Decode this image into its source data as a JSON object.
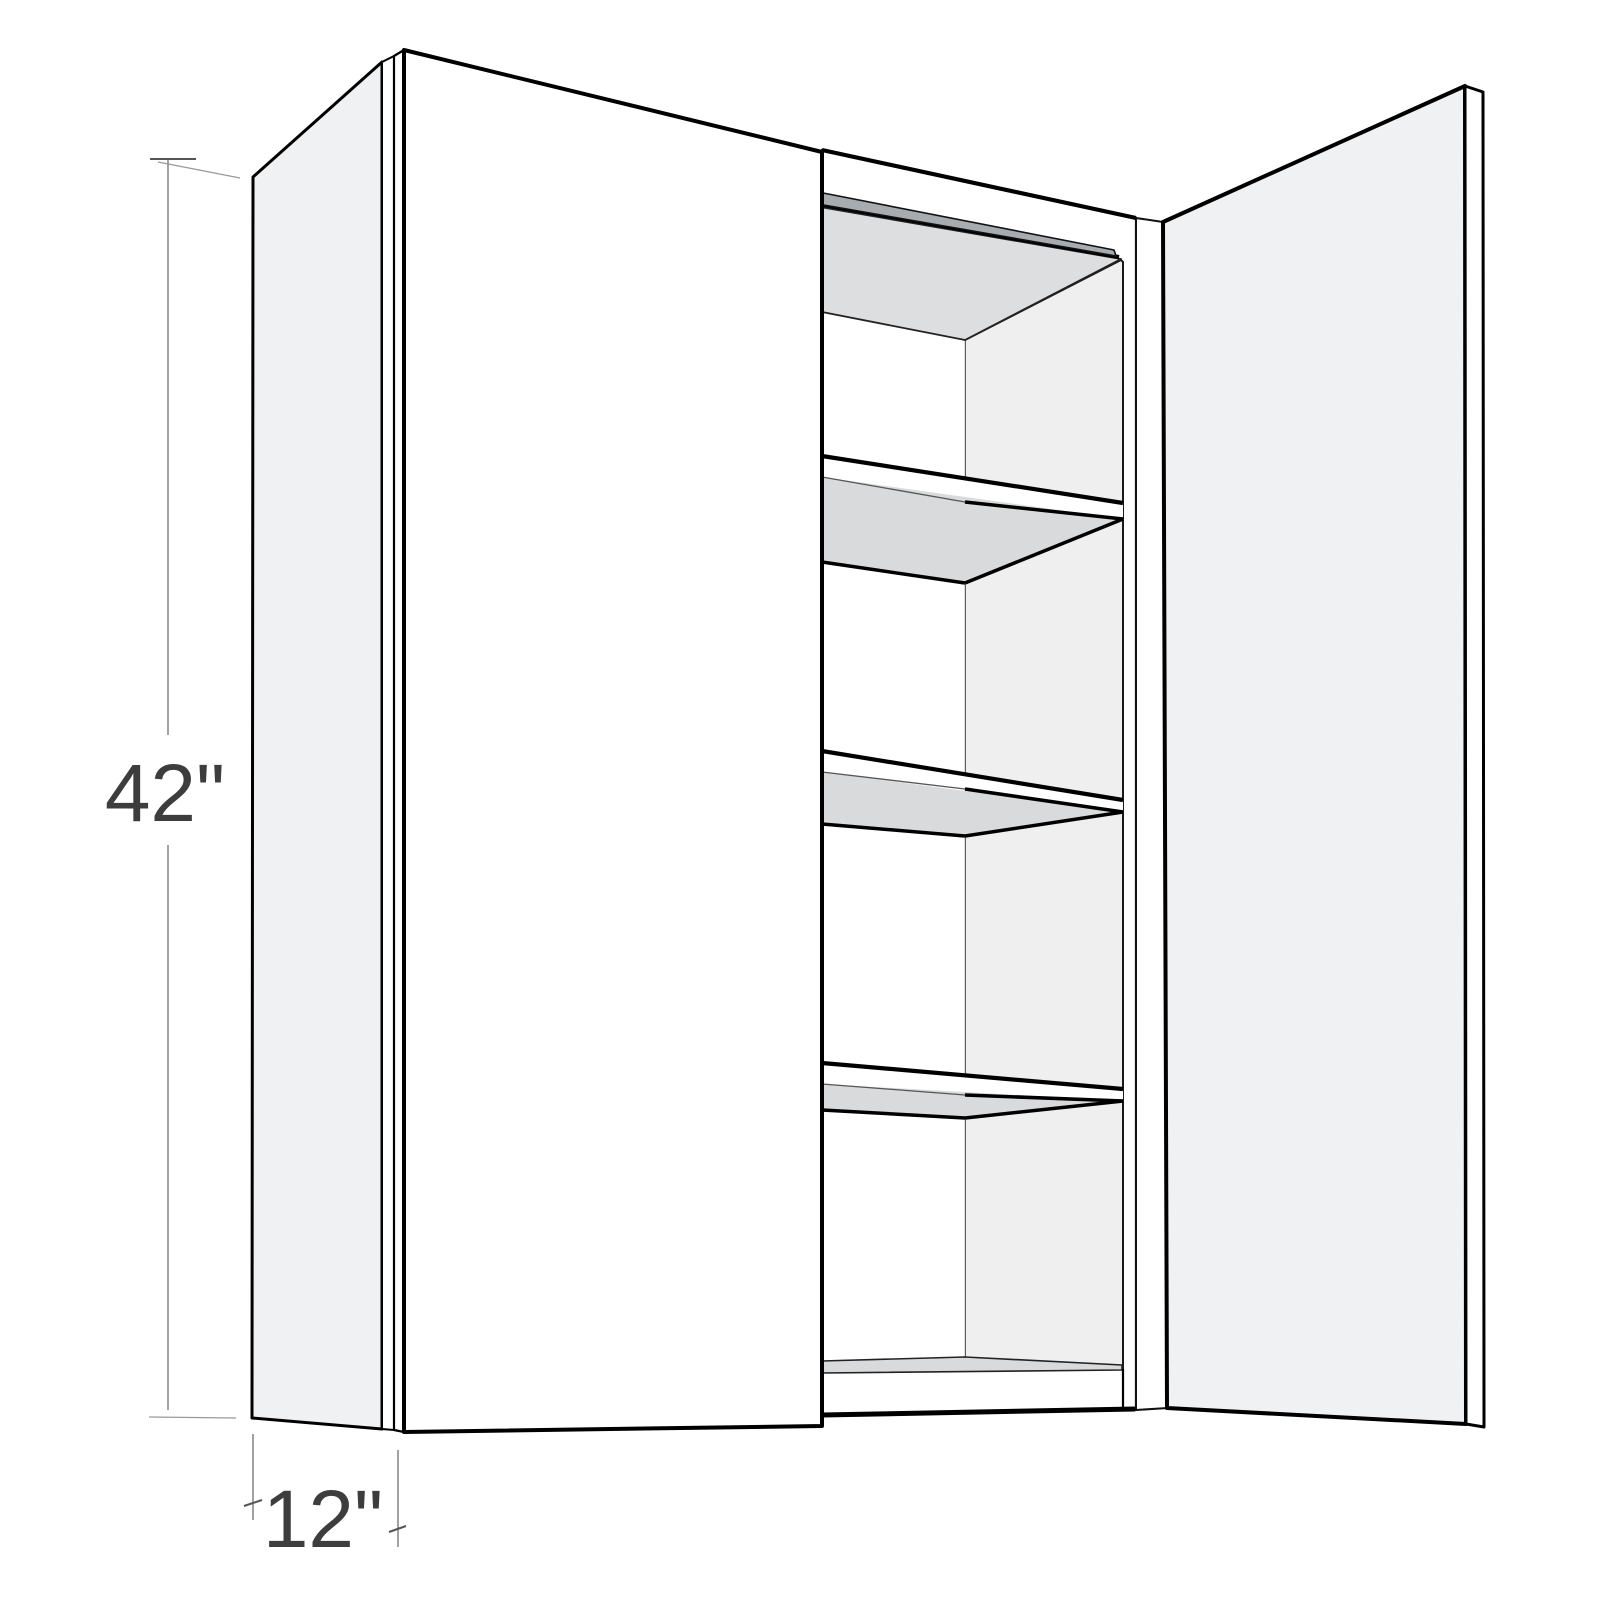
{
  "page": {
    "background_color": "#ffffff",
    "content_type": "product-dimension-illustration"
  },
  "diagram": {
    "subject": "Two-door frameless wall cabinet, left door closed, right door swung open, three adjustable interior shelves plus bottom deck",
    "view": "three-quarter perspective from front-left",
    "dimensions": {
      "height": {
        "label": "42\"",
        "value": 42,
        "unit": "in",
        "orientation": "vertical-left"
      },
      "depth": {
        "label": "12\"",
        "value": 12,
        "unit": "in",
        "orientation": "bottom-perspective"
      }
    },
    "colors": {
      "outline": "#000000",
      "panel_face_light": "#f0f1f2",
      "panel_face_white": "#ffffff",
      "interior_surface_shade": "#d8dadb",
      "interior_right_wall": "#efefef",
      "hang_rail_dark": "#a7acb1",
      "dimension_line": "#8a8a8a",
      "dimension_text": "#3d3d3d"
    }
  }
}
